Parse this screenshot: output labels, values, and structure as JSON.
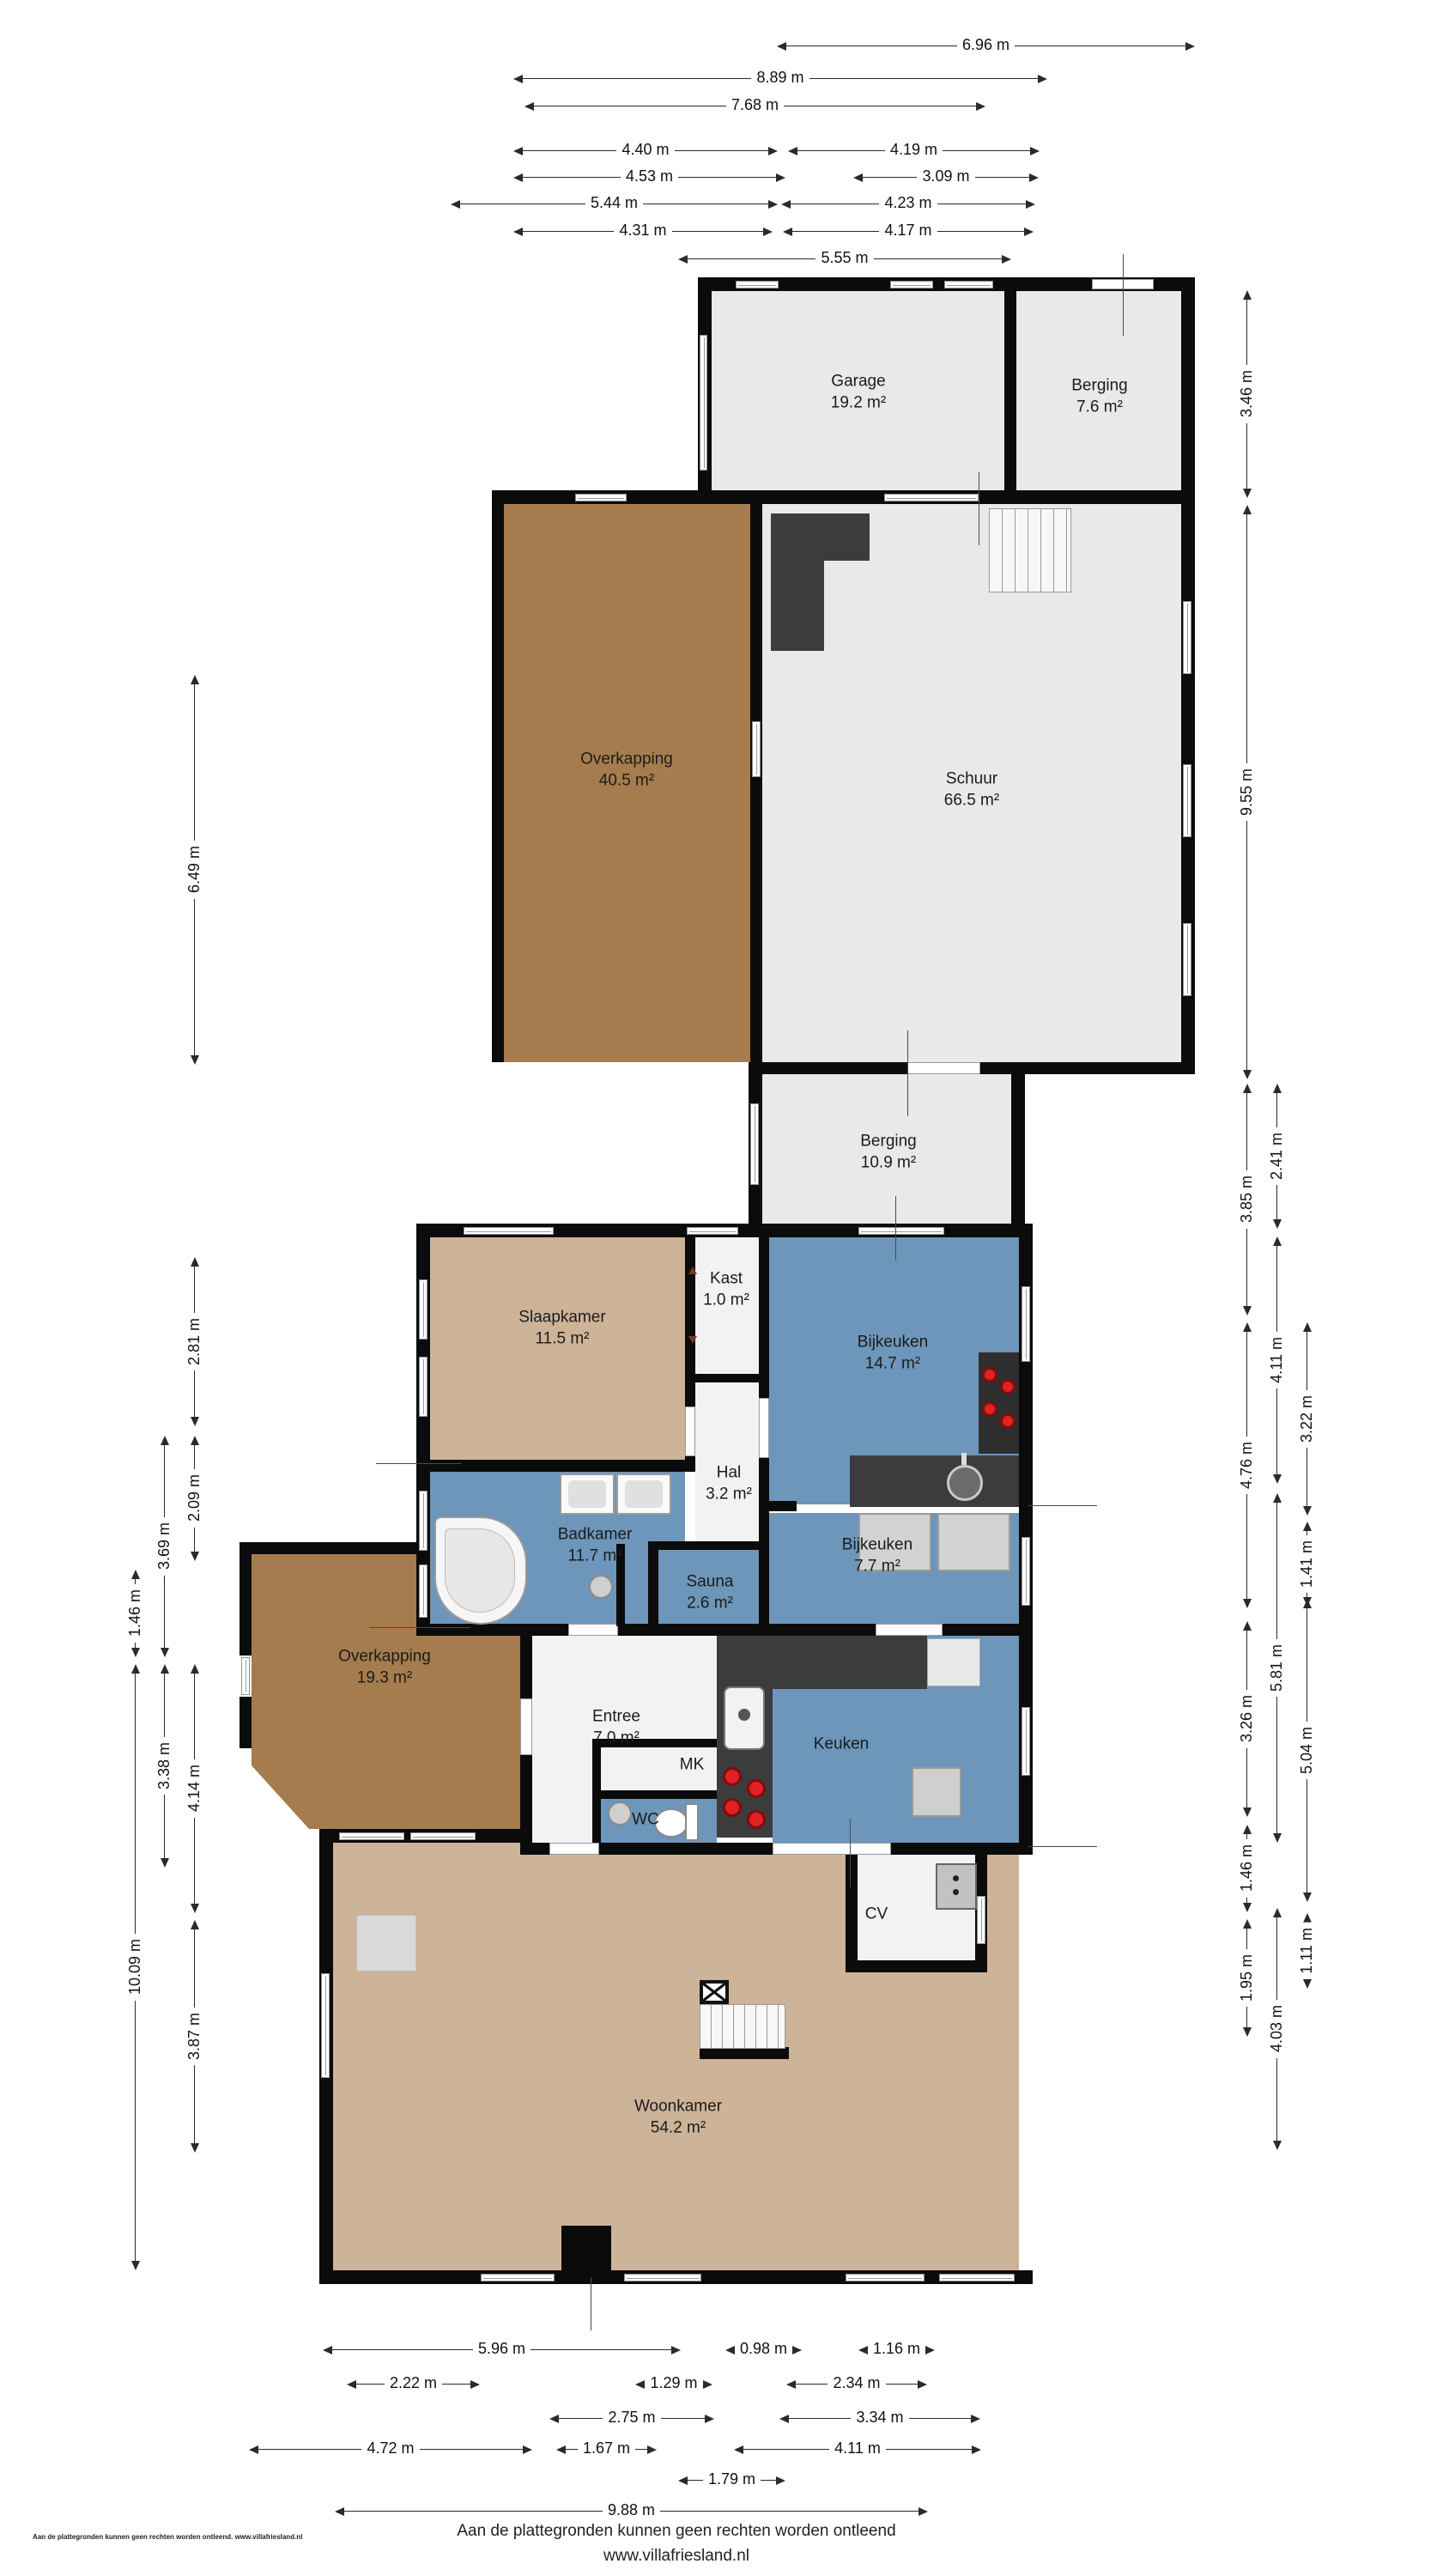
{
  "rooms": [
    {
      "name": "Garage",
      "area": "19.2 m²"
    },
    {
      "name": "Berging",
      "area": "7.6 m²"
    },
    {
      "name": "Overkapping",
      "area": "40.5 m²"
    },
    {
      "name": "Schuur",
      "area": "66.5 m²"
    },
    {
      "name": "Berging",
      "area": "10.9 m²"
    },
    {
      "name": "Slaapkamer",
      "area": "11.5 m²"
    },
    {
      "name": "Kast",
      "area": "1.0 m²"
    },
    {
      "name": "Bijkeuken",
      "area": "14.7 m²"
    },
    {
      "name": "Hal",
      "area": "3.2 m²"
    },
    {
      "name": "Badkamer",
      "area": "11.7 m²"
    },
    {
      "name": "Sauna",
      "area": "2.6 m²"
    },
    {
      "name": "Bijkeuken",
      "area": "7.7 m²"
    },
    {
      "name": "Overkapping",
      "area": "19.3 m²"
    },
    {
      "name": "Entree",
      "area": "7.0 m²"
    },
    {
      "name": "MK",
      "area": ""
    },
    {
      "name": "WC",
      "area": ""
    },
    {
      "name": "Keuken",
      "area": ""
    },
    {
      "name": "CV",
      "area": ""
    },
    {
      "name": "Woonkamer",
      "area": "54.2 m²"
    }
  ],
  "dims": {
    "top": [
      "6.96 m",
      "8.89 m",
      "7.68 m",
      "4.40 m",
      "4.19 m",
      "4.53 m",
      "3.09 m",
      "5.44 m",
      "4.23 m",
      "4.31 m",
      "4.17 m",
      "5.55 m"
    ],
    "bottom": [
      "5.96 m",
      "0.98 m",
      "1.16 m",
      "2.22 m",
      "1.29 m",
      "2.34 m",
      "2.75 m",
      "3.34 m",
      "4.72 m",
      "1.67 m",
      "4.11 m",
      "1.79 m",
      "9.88 m"
    ],
    "left": [
      "6.49 m",
      "2.81 m",
      "2.09 m",
      "3.69 m",
      "1.46 m",
      "4.14 m",
      "3.38 m",
      "10.09 m",
      "3.87 m"
    ],
    "right": [
      "3.46 m",
      "9.55 m",
      "2.41 m",
      "3.85 m",
      "4.11 m",
      "3.22 m",
      "4.76 m",
      "1.41 m",
      "5.81 m",
      "3.26 m",
      "5.04 m",
      "1.46 m",
      "1.95 m",
      "1.11 m",
      "4.03 m"
    ]
  },
  "footer": {
    "line1": "Aan de plattegronden kunnen geen rechten worden ontleend",
    "line2": "www.villafriesland.nl",
    "small_print": "Aan de plattegronden kunnen geen rechten worden ontleend. www.villafriesland.nl"
  },
  "colors": {
    "wall": "#0b0b0b",
    "room_gray": "#e9e9e9",
    "room_blue": "#6d96ba",
    "room_tan": "#cdb397",
    "room_brown": "#a57c4e",
    "counter_dark": "#3c3c3c",
    "burner_red": "#e02222",
    "appliance_gray": "#d2d2d2"
  }
}
